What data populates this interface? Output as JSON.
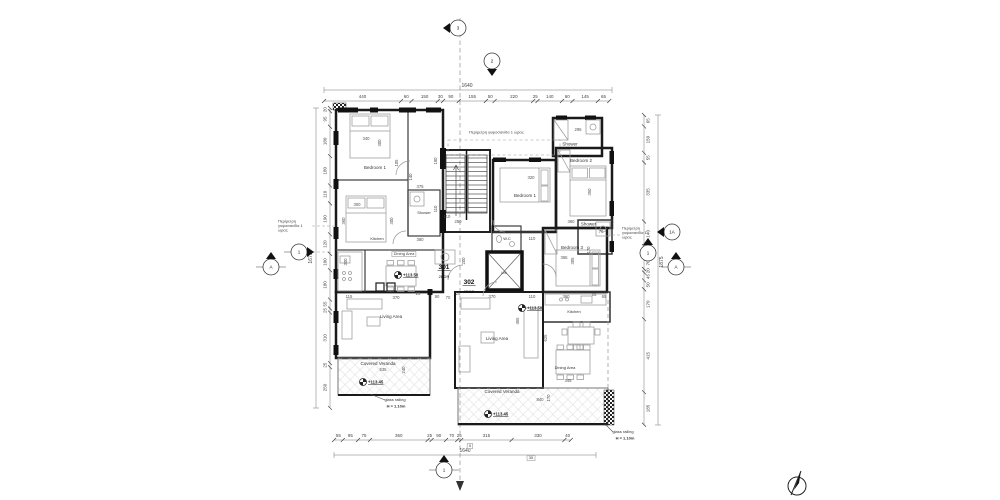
{
  "drawing": {
    "units": [
      {
        "number": "301",
        "type": "2BDR"
      },
      {
        "number": "302",
        "type": "2BDR"
      }
    ],
    "rooms": {
      "left": {
        "bedroom1": "Bedroom 1",
        "shower": "Shower",
        "kitchen": "Kitchen",
        "dining": "Dining Area",
        "living": "Living Area",
        "veranda": "Covered Veranda"
      },
      "right": {
        "shower_top": "Shower",
        "bedroom2": "Bedroom 2",
        "bedroom1": "Bedroom 1",
        "shower2": "Shower",
        "bedroom3": "Bedroom 3",
        "kitchen": "Kitchen",
        "living": "Living Area",
        "dining": "Dining Area",
        "veranda": "Covered Veranda"
      },
      "core": {
        "wc": "W.C",
        "lift": "Lift"
      }
    },
    "notes": {
      "fireproof_left": [
        "Περίμετρη",
        "γυψοσανίδα 1",
        "ώρας"
      ],
      "fireproof_top": "Περίμετρη γυψοσανίδα 1 ώρας",
      "fireproof_right": [
        "Περίμετρη",
        "γυψοσανίδα 1",
        "ώρας"
      ],
      "railing": "glass railing",
      "railing_h": "H = 1.10m",
      "level_living": "+113.50",
      "level_veranda": "+113.45"
    },
    "dims": {
      "top": {
        "overall": "1640",
        "values": [
          "440",
          "60",
          "150",
          "30",
          "90",
          "155",
          "50",
          "220",
          "25",
          "140",
          "60",
          "145",
          "65"
        ]
      },
      "bottom": {
        "overall": "1640",
        "values": [
          "55",
          "95",
          "75",
          "360",
          "25",
          "90",
          "70",
          "25",
          "315",
          "330",
          "40"
        ],
        "boxed": [
          "5",
          "35"
        ]
      },
      "left": {
        "overall": "1675",
        "values": [
          "20",
          "95",
          "180",
          "180",
          "110",
          "190",
          "120",
          "100",
          "180",
          "55",
          "25",
          "310",
          "25",
          "250"
        ]
      },
      "right": {
        "overall": "1875",
        "values": [
          "65",
          "150",
          "55",
          "335",
          "140",
          "60",
          "70",
          "20",
          "45",
          "50",
          "170",
          "415",
          "185"
        ]
      }
    },
    "plan_dims": [
      {
        "t": "340",
        "x": 732,
        "y": 280
      },
      {
        "t": "300",
        "x": 762,
        "y": 286,
        "r": 1
      },
      {
        "t": "105",
        "x": 796,
        "y": 326,
        "r": 1
      },
      {
        "t": "180",
        "x": 874,
        "y": 322,
        "r": 1
      },
      {
        "t": "300",
        "x": 714,
        "y": 412
      },
      {
        "t": "360",
        "x": 690,
        "y": 442,
        "r": 1
      },
      {
        "t": "300",
        "x": 786,
        "y": 442,
        "r": 1
      },
      {
        "t": "375",
        "x": 840,
        "y": 376
      },
      {
        "t": "140",
        "x": 824,
        "y": 354,
        "r": 1
      },
      {
        "t": "110",
        "x": 874,
        "y": 418,
        "r": 1
      },
      {
        "t": "250",
        "x": 916,
        "y": 446
      },
      {
        "t": "380",
        "x": 840,
        "y": 482
      },
      {
        "t": "300",
        "x": 694,
        "y": 524,
        "r": 1
      },
      {
        "t": "295",
        "x": 1156,
        "y": 262
      },
      {
        "t": "320",
        "x": 1062,
        "y": 358
      },
      {
        "t": "350",
        "x": 1182,
        "y": 384,
        "r": 1
      },
      {
        "t": "360",
        "x": 1142,
        "y": 446
      },
      {
        "t": "110",
        "x": 1064,
        "y": 480
      },
      {
        "t": "365",
        "x": 1128,
        "y": 518
      },
      {
        "t": "305",
        "x": 1148,
        "y": 522,
        "r": 1
      },
      {
        "t": "70",
        "x": 1202,
        "y": 466
      },
      {
        "t": "170",
        "x": 1180,
        "y": 500,
        "r": 1
      },
      {
        "t": "115",
        "x": 698,
        "y": 596
      },
      {
        "t": "370",
        "x": 792,
        "y": 598
      },
      {
        "t": "25",
        "x": 836,
        "y": 590
      },
      {
        "t": "90",
        "x": 874,
        "y": 596
      },
      {
        "t": "70",
        "x": 896,
        "y": 598
      },
      {
        "t": "25",
        "x": 916,
        "y": 590
      },
      {
        "t": "370",
        "x": 984,
        "y": 596
      },
      {
        "t": "110",
        "x": 1064,
        "y": 596
      },
      {
        "t": "360",
        "x": 1132,
        "y": 596
      },
      {
        "t": "25",
        "x": 1188,
        "y": 592
      },
      {
        "t": "65",
        "x": 1208,
        "y": 596
      },
      {
        "t": "455",
        "x": 1038,
        "y": 642,
        "r": 1
      },
      {
        "t": "625",
        "x": 1094,
        "y": 676,
        "r": 1
      },
      {
        "t": "535",
        "x": 766,
        "y": 742
      },
      {
        "t": "240",
        "x": 810,
        "y": 740,
        "r": 1
      },
      {
        "t": "840",
        "x": 1080,
        "y": 802
      },
      {
        "t": "170",
        "x": 1100,
        "y": 796,
        "r": 1
      },
      {
        "t": "345",
        "x": 1136,
        "y": 764
      },
      {
        "t": "200",
        "x": 930,
        "y": 522,
        "r": 1
      },
      {
        "t": "110",
        "x": 894,
        "y": 436
      }
    ],
    "markers": [
      {
        "label": "3",
        "x": 916,
        "y": 56,
        "dir": "left"
      },
      {
        "label": "2",
        "x": 984,
        "y": 122,
        "dir": "down"
      },
      {
        "label": "1",
        "x": 598,
        "y": 504,
        "dir": "right",
        "hline": true
      },
      {
        "label": "A",
        "x": 542,
        "y": 534,
        "dir": "up",
        "hline": true
      },
      {
        "label": "1A",
        "x": 1344,
        "y": 464,
        "dir": "left"
      },
      {
        "label": "1",
        "x": 1296,
        "y": 506,
        "dir": "up"
      },
      {
        "label": "A",
        "x": 1352,
        "y": 534,
        "dir": "up",
        "hline": true
      },
      {
        "label": "1",
        "x": 888,
        "y": 940,
        "dir": "up",
        "hline": true
      }
    ]
  }
}
